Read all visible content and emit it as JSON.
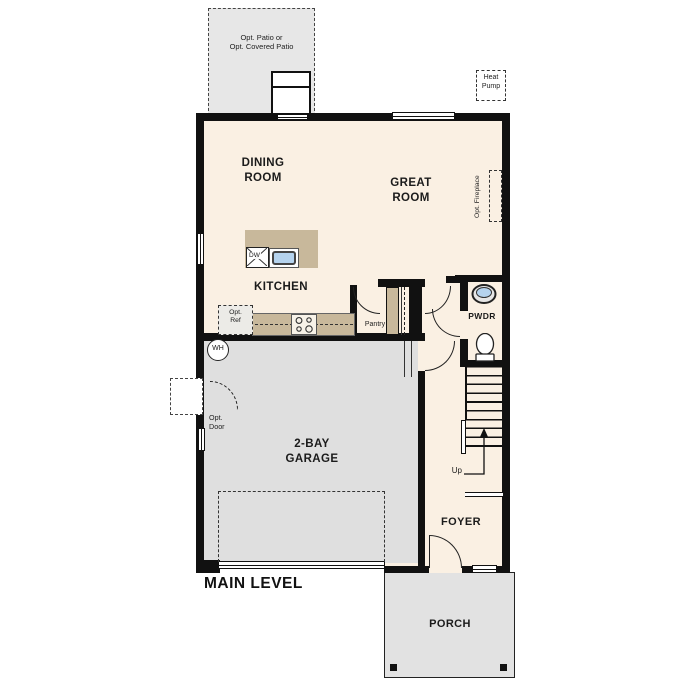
{
  "title": "MAIN LEVEL",
  "colors": {
    "wall": "#111111",
    "interior": "#faf0e3",
    "tan": "#c8b89b",
    "garage": "#dfdfdf",
    "patio": "#e7e7e7",
    "porch": "#e2e2e2",
    "sink": "#b5d3ee",
    "line": "#222222"
  },
  "rooms": {
    "dining": {
      "line1": "DINING",
      "line2": "ROOM"
    },
    "great": {
      "line1": "GREAT",
      "line2": "ROOM"
    },
    "kitchen": {
      "label": "KITCHEN"
    },
    "garage": {
      "line1": "2-BAY",
      "line2": "GARAGE"
    },
    "foyer": {
      "label": "FOYER"
    },
    "porch": {
      "label": "PORCH"
    },
    "powder": {
      "label": "PWDR"
    },
    "pantry": {
      "label": "Pantry"
    }
  },
  "annotations": {
    "patio": {
      "line1": "Opt. Patio or",
      "line2": "Opt. Covered Patio"
    },
    "heat_pump": {
      "line1": "Heat",
      "line2": "Pump"
    },
    "opt_fireplace": "Opt. Fireplace",
    "opt_ref": {
      "line1": "Opt.",
      "line2": "Ref"
    },
    "opt_door": {
      "line1": "Opt.",
      "line2": "Door"
    },
    "water_heater": "WH",
    "dishwasher": "DW",
    "stairs_up": "Up"
  }
}
